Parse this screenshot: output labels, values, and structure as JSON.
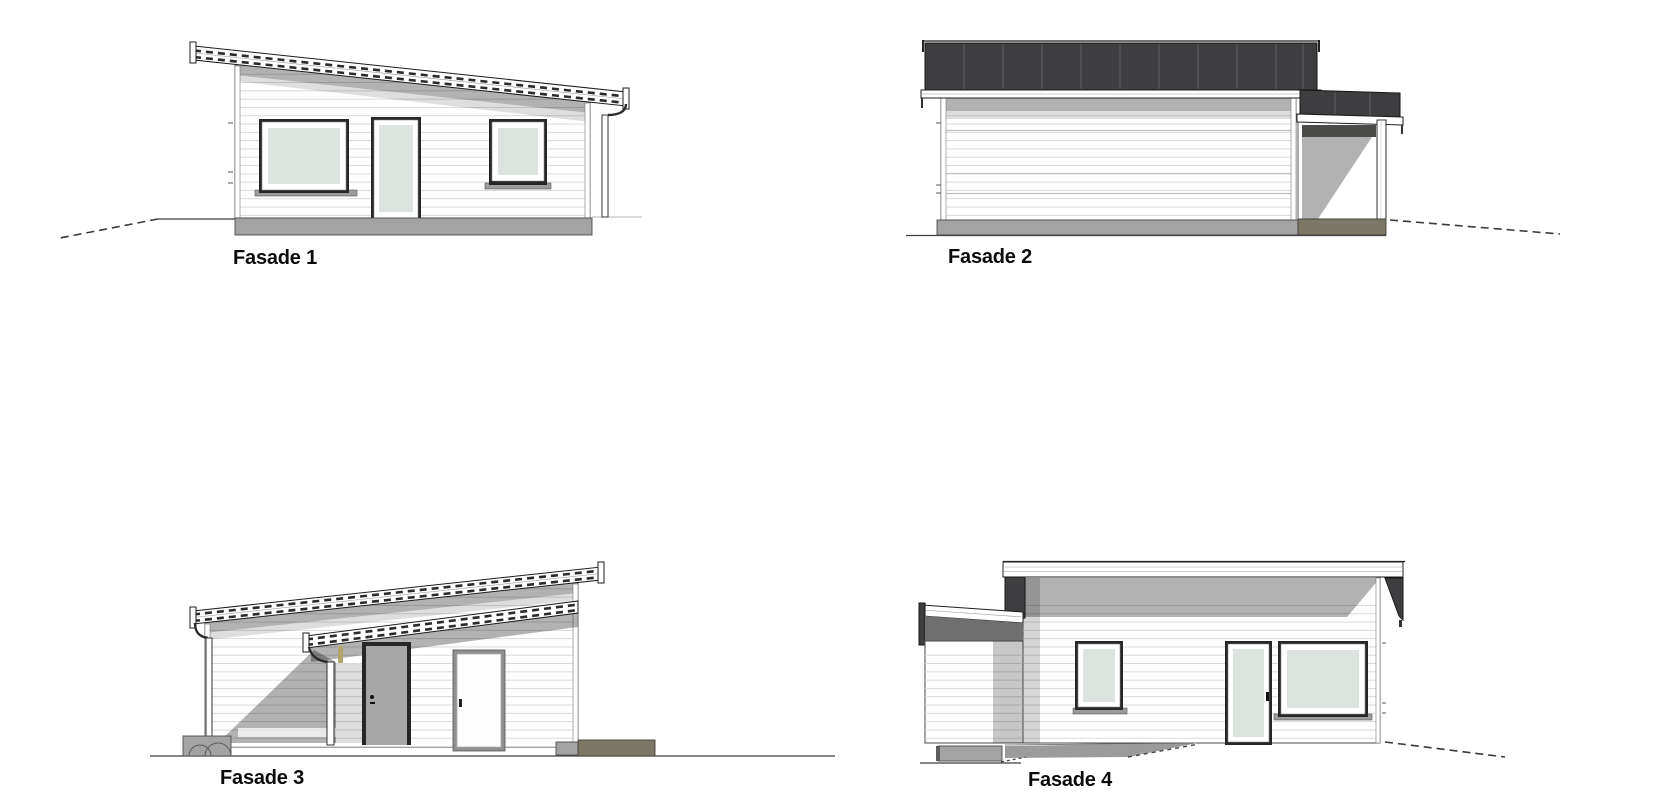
{
  "document": {
    "background": "#ffffff",
    "kind": "architectural facade elevation sheet",
    "view_count": 4
  },
  "palette": {
    "wall_white": "#ffffff",
    "roof_dark": "#3e3e40",
    "roof_seam": "#5e5e60",
    "siding_line": "#d6d6d6",
    "glass": "#dde4e0",
    "door_gray": "#a7a7a7",
    "foundation": "#a3a3a3",
    "foundation_dark": "#7d7767",
    "trim_tan": "#b3a66a",
    "line": "#1c1c1c",
    "label": "#0b0b0b"
  },
  "elevations": [
    {
      "id": "fasade-1",
      "label": "Fasade 1"
    },
    {
      "id": "fasade-2",
      "label": "Fasade 2"
    },
    {
      "id": "fasade-3",
      "label": "Fasade 3"
    },
    {
      "id": "fasade-4",
      "label": "Fasade 4"
    }
  ]
}
